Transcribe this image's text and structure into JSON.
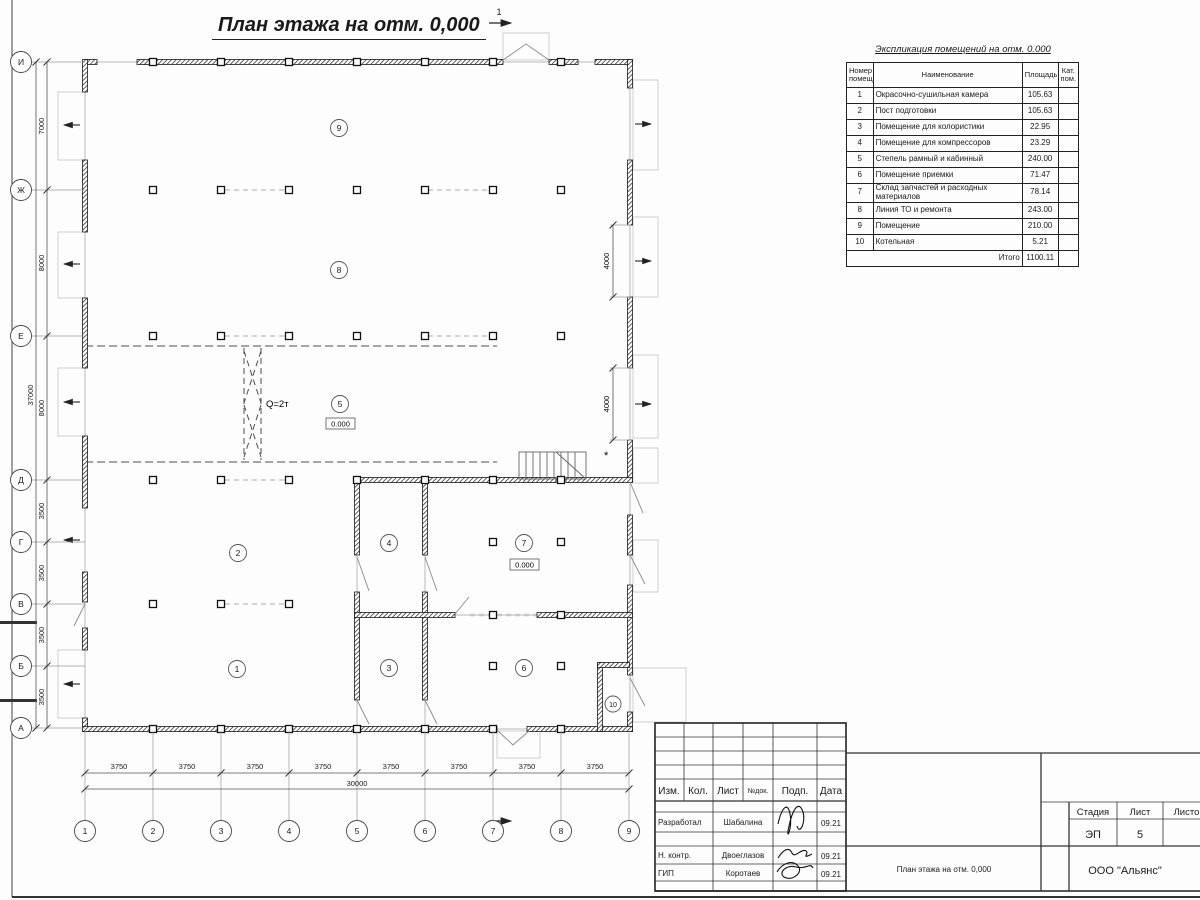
{
  "sheet": {
    "plan_title": "План этажа на отм. 0,000",
    "colors": {
      "ink": "#1a1a1a",
      "dim_lines": "#555555",
      "light_lines": "#bbbbbb"
    },
    "schedule": {
      "title": "Экспликация помещений на отм. 0.000",
      "columns": {
        "num": "Номер помещ.",
        "name": "Наименование",
        "area": "Площадь",
        "cat": "Кат. пом."
      },
      "rows": [
        [
          "1",
          "Окрасочно-сушильная камера",
          "105.63"
        ],
        [
          "2",
          "Пост подготовки",
          "105.63"
        ],
        [
          "3",
          "Помещение для колористики",
          "22.95"
        ],
        [
          "4",
          "Помещение для компрессоров",
          "23.29"
        ],
        [
          "5",
          "Степель рамный и кабинный",
          "240.00"
        ],
        [
          "6",
          "Помещение приемки",
          "71.47"
        ],
        [
          "7",
          "Склад запчастей и расходных материалов",
          "78.14"
        ],
        [
          "8",
          "Линия ТО и ремонта",
          "243.00"
        ],
        [
          "9",
          "Помещение",
          "210.00"
        ],
        [
          "10",
          "Котельная",
          "5.21"
        ]
      ],
      "total_label": "Итого",
      "total_value": "1100.11"
    },
    "axes": {
      "rows": [
        "И",
        "Ж",
        "Е",
        "Д",
        "Г",
        "В",
        "Б",
        "А"
      ],
      "cols": [
        "1",
        "2",
        "3",
        "4",
        "5",
        "6",
        "7",
        "8",
        "9"
      ],
      "row_dims": [
        "7000",
        "8000",
        "8000",
        "3500",
        "3500",
        "3500",
        "3500"
      ],
      "row_total": "37000",
      "col_dims": [
        "3750",
        "3750",
        "3750",
        "3750",
        "3750",
        "3750",
        "3750",
        "3750"
      ],
      "col_total": "30000",
      "gate_dims": [
        "4000",
        "4000"
      ]
    },
    "plan_labels": {
      "rooms": [
        "1",
        "2",
        "3",
        "4",
        "5",
        "6",
        "7",
        "8",
        "9",
        "10"
      ],
      "crane": "Q=2т",
      "elevation": "0.000",
      "section_mark": "1",
      "asterisk": "*"
    },
    "titleblock": {
      "header_cols": {
        "izm": "Изм.",
        "kol": "Кол.",
        "list": "Лист",
        "ndok": "№док.",
        "podp": "Подп.",
        "data": "Дата"
      },
      "sign_rows": [
        {
          "role": "Разработал",
          "name": "Шабалина",
          "date": "09.21"
        },
        {
          "role": "Н. контр.",
          "name": "Двоеглазов",
          "date": "09.21"
        },
        {
          "role": "ГИП",
          "name": "Коротаев",
          "date": "09.21"
        }
      ],
      "stage_label": "Стадия",
      "sheet_label": "Лист",
      "sheets_label": "Листов",
      "stage": "ЭП",
      "sheet_no": "5",
      "doc_title": "План этажа на отм. 0,000",
      "company": "ООО \"Альянс\""
    }
  }
}
